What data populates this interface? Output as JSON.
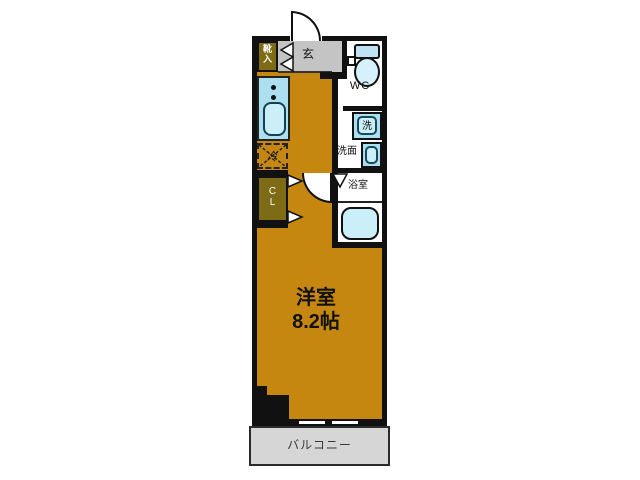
{
  "floor_plan": {
    "title": "1K apartment floor plan",
    "labels": {
      "entrance": "玄",
      "shoe_cabinet": "靴\n入",
      "toilet": "WC",
      "washer": "洗",
      "washroom": "洗面",
      "bathroom": "浴室",
      "refrigerator": "冷",
      "closet": "C\nL",
      "room_name": "洋室",
      "room_size": "8.2帖",
      "balcony": "バルコニー"
    },
    "colors": {
      "floor_orange": "#C5870F",
      "entrance_tile_gray": "#C4C4C4",
      "balcony_gray": "#D6D6D6",
      "cabinet_olive": "#7E6B15",
      "fixture_blue": "#ACDFF0",
      "fixture_blue_light": "#CBEFF9",
      "wall_black": "#111111"
    }
  }
}
